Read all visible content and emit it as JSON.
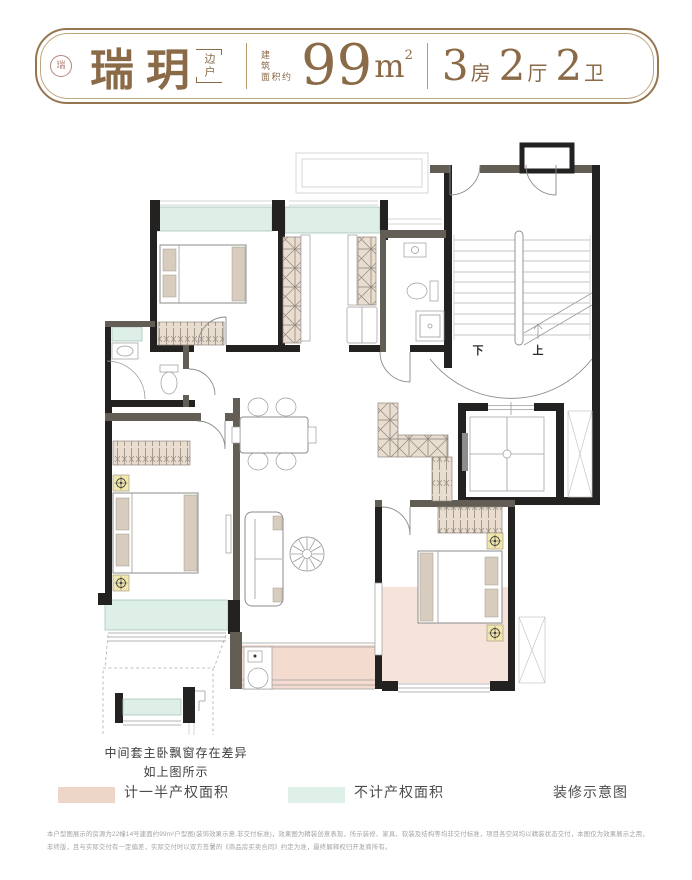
{
  "header": {
    "brand": "瑞玥",
    "seal_char": "瑞",
    "edge_label": "边户",
    "area_prefix_line1": "建筑",
    "area_prefix_line2": "面积约",
    "area_value": "99",
    "area_unit": "m",
    "area_sup": "2",
    "rooms": [
      {
        "num": "3",
        "unit": "房"
      },
      {
        "num": "2",
        "unit": "厅"
      },
      {
        "num": "2",
        "unit": "卫"
      }
    ]
  },
  "plan": {
    "stair_down_label": "下",
    "stair_up_label": "上",
    "note_line1": "中间套主卧飘窗存在差异",
    "note_line2": "如上图所示"
  },
  "legend": {
    "half_property": {
      "label": "计一半产权面积",
      "color": "#edd5c8"
    },
    "no_property": {
      "label": "不计产权面积",
      "color": "#dff0e8"
    },
    "caption": "装修示意图"
  },
  "disclaimer": {
    "line1": "本户型图展示的房源为22幢14号建面约99m²户型图(装饰效果示意,非交付标准)，效果图为精装创意表现，所示装修、家具、软装及结构等均非交付标准，项目各空间均以精装状态交付，本图仅为效果展示之用，",
    "line2": "非终版，且与实际交付有一定偏差，实际交付时以双方签署的《商品房买卖合同》约定为准，最终解释权归开发商所有。"
  },
  "colors": {
    "accent_brown": "#8a6a47",
    "wall_black": "#232220",
    "wall_gray": "#625d55",
    "window_green": "#ddefe6",
    "balcony_pink": "#f3dbd0"
  }
}
